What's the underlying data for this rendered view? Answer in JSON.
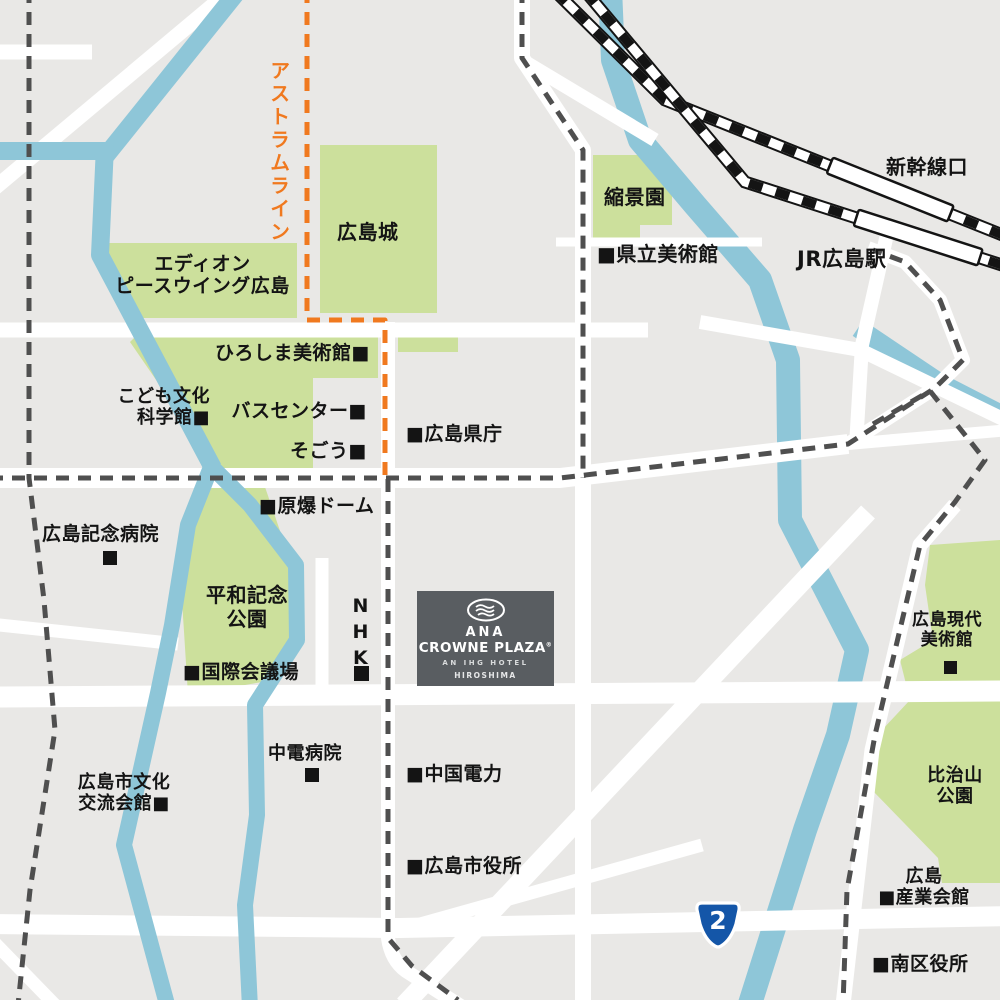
{
  "map": {
    "title": "Hiroshima access map (ANA Crowne Plaza Hiroshima)",
    "colors": {
      "background": "#e9e8e6",
      "road": "#ffffff",
      "river": "#8ec6d8",
      "park_green": "#cce09c",
      "railway_black": "#141414",
      "tram_dash_gray": "#4f4f4f",
      "astram_orange": "#f0791f",
      "hotel_block": "#595d61",
      "route_shield_blue": "#1456a8",
      "label_text": "#141414"
    },
    "labels": {
      "astram_line": "アストラムライン",
      "hiroshima_castle": "広島城",
      "shukkeien": "縮景園",
      "prefectural_art_museum": "■県立美術館",
      "shinkansen_exit": "新幹線口",
      "jr_hiroshima_station": "JR広島駅",
      "edion_peace_wing": "エディオン\nピースウイング広島",
      "hiroshima_museum_of_art": "ひろしま美術館■",
      "children_science_museum": "こども文化\n科学館■",
      "bus_center": "バスセンター■",
      "sogo": "そごう■",
      "prefectural_office": "■広島県庁",
      "atomic_bomb_dome": "■原爆ドーム",
      "memorial_hospital": "広島記念病院",
      "peace_memorial_park": "平和記念\n公園",
      "nhk": "NHK",
      "intl_conference_center": "■国際会議場",
      "contemporary_art_museum": "広島現代\n美術館",
      "hijiyama_park": "比治山\n公園",
      "chuden_hospital": "中電病院",
      "chugoku_electric": "■中国電力",
      "culture_exchange_hall": "広島市文化\n交流会館■",
      "city_hall": "■広島市役所",
      "industry_hall": "広島\n■産業会館",
      "minami_ward_office": "■南区役所"
    },
    "hotel": {
      "brand_top": "ANA",
      "brand": "CROWNE PLAZA",
      "reg": "®",
      "tagline": "AN IHG HOTEL",
      "location": "HIROSHIMA"
    },
    "route_shield": {
      "number": "2"
    }
  }
}
